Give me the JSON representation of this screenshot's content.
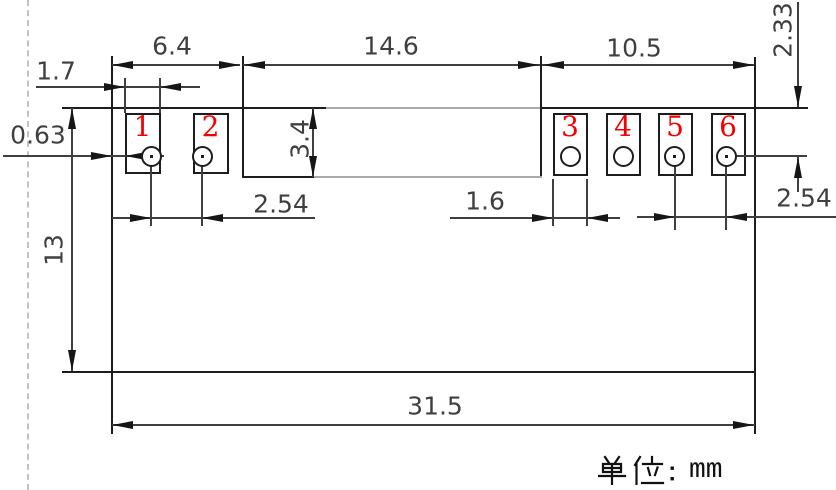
{
  "dims": {
    "d6_4": "6.4",
    "d14_6": "14.6",
    "d10_5": "10.5",
    "d1_7": "1.7",
    "d0_63": "0.63",
    "d3_4": "3.4",
    "d13": "13",
    "d2_54_left": "2.54",
    "d1_6": "1.6",
    "d2_54_right": "2.54",
    "d2_33": "2.33",
    "d31_5": "31.5"
  },
  "pads": {
    "numbers": [
      "1",
      "2",
      "3",
      "4",
      "5",
      "6"
    ]
  },
  "unit": {
    "cjk": "单位：",
    "latin": "mm",
    "full": "单位：mm"
  },
  "colors": {
    "pad_number": "#f40000",
    "structure_line": "#1d1d1d",
    "dim_text": "#3f3f3f",
    "dashed_line": "#c2c2c2"
  }
}
